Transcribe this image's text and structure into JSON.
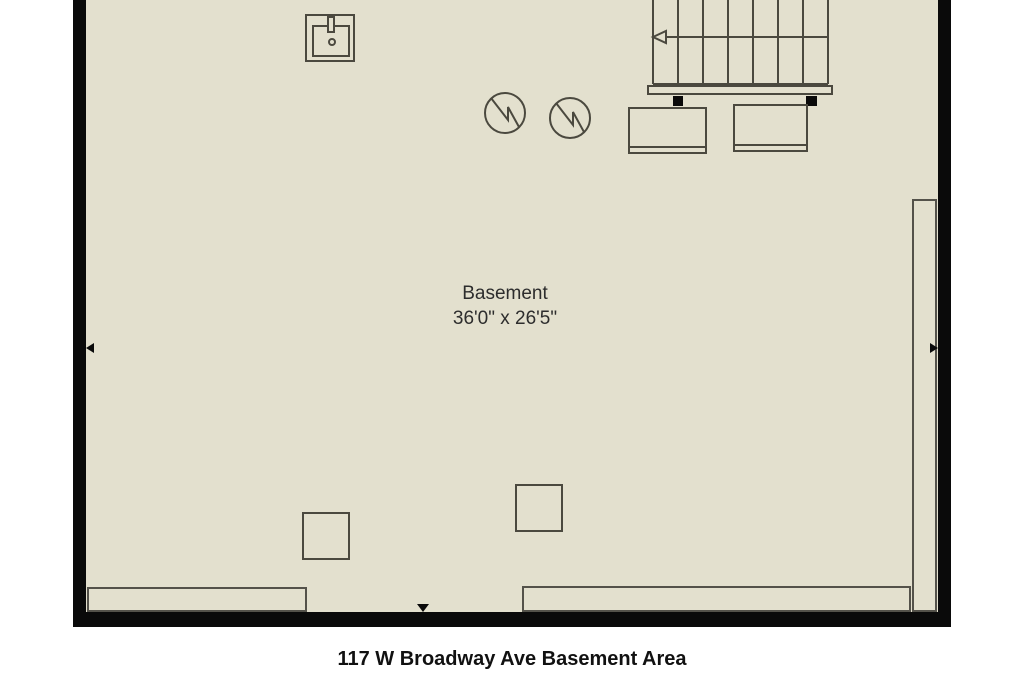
{
  "colors": {
    "background": "#ffffff",
    "floor": "#e3e0ce",
    "wall": "#0a0a0a",
    "fixture_line": "#4b493f",
    "ledge_line": "#54524a",
    "label_text": "#2d2d2d",
    "caption_text": "#111111"
  },
  "room": {
    "label": "Basement",
    "dimensions": "36'0\" x 26'5\""
  },
  "caption": "117 W Broadway Ave Basement Area",
  "fixtures": {
    "sink_icon": "utility-sink-icon",
    "staircase": {
      "icon": "staircase-icon",
      "treads": 7,
      "direction_arrow": "left"
    },
    "water_heater_icons": [
      "water-heater-icon",
      "water-heater-icon"
    ],
    "appliance_count": 2,
    "support_post_count": 2,
    "floor_square_count": 2,
    "window_ledge_count": 3,
    "measurement_markers": [
      "left-wall",
      "right-wall",
      "bottom-wall"
    ]
  }
}
